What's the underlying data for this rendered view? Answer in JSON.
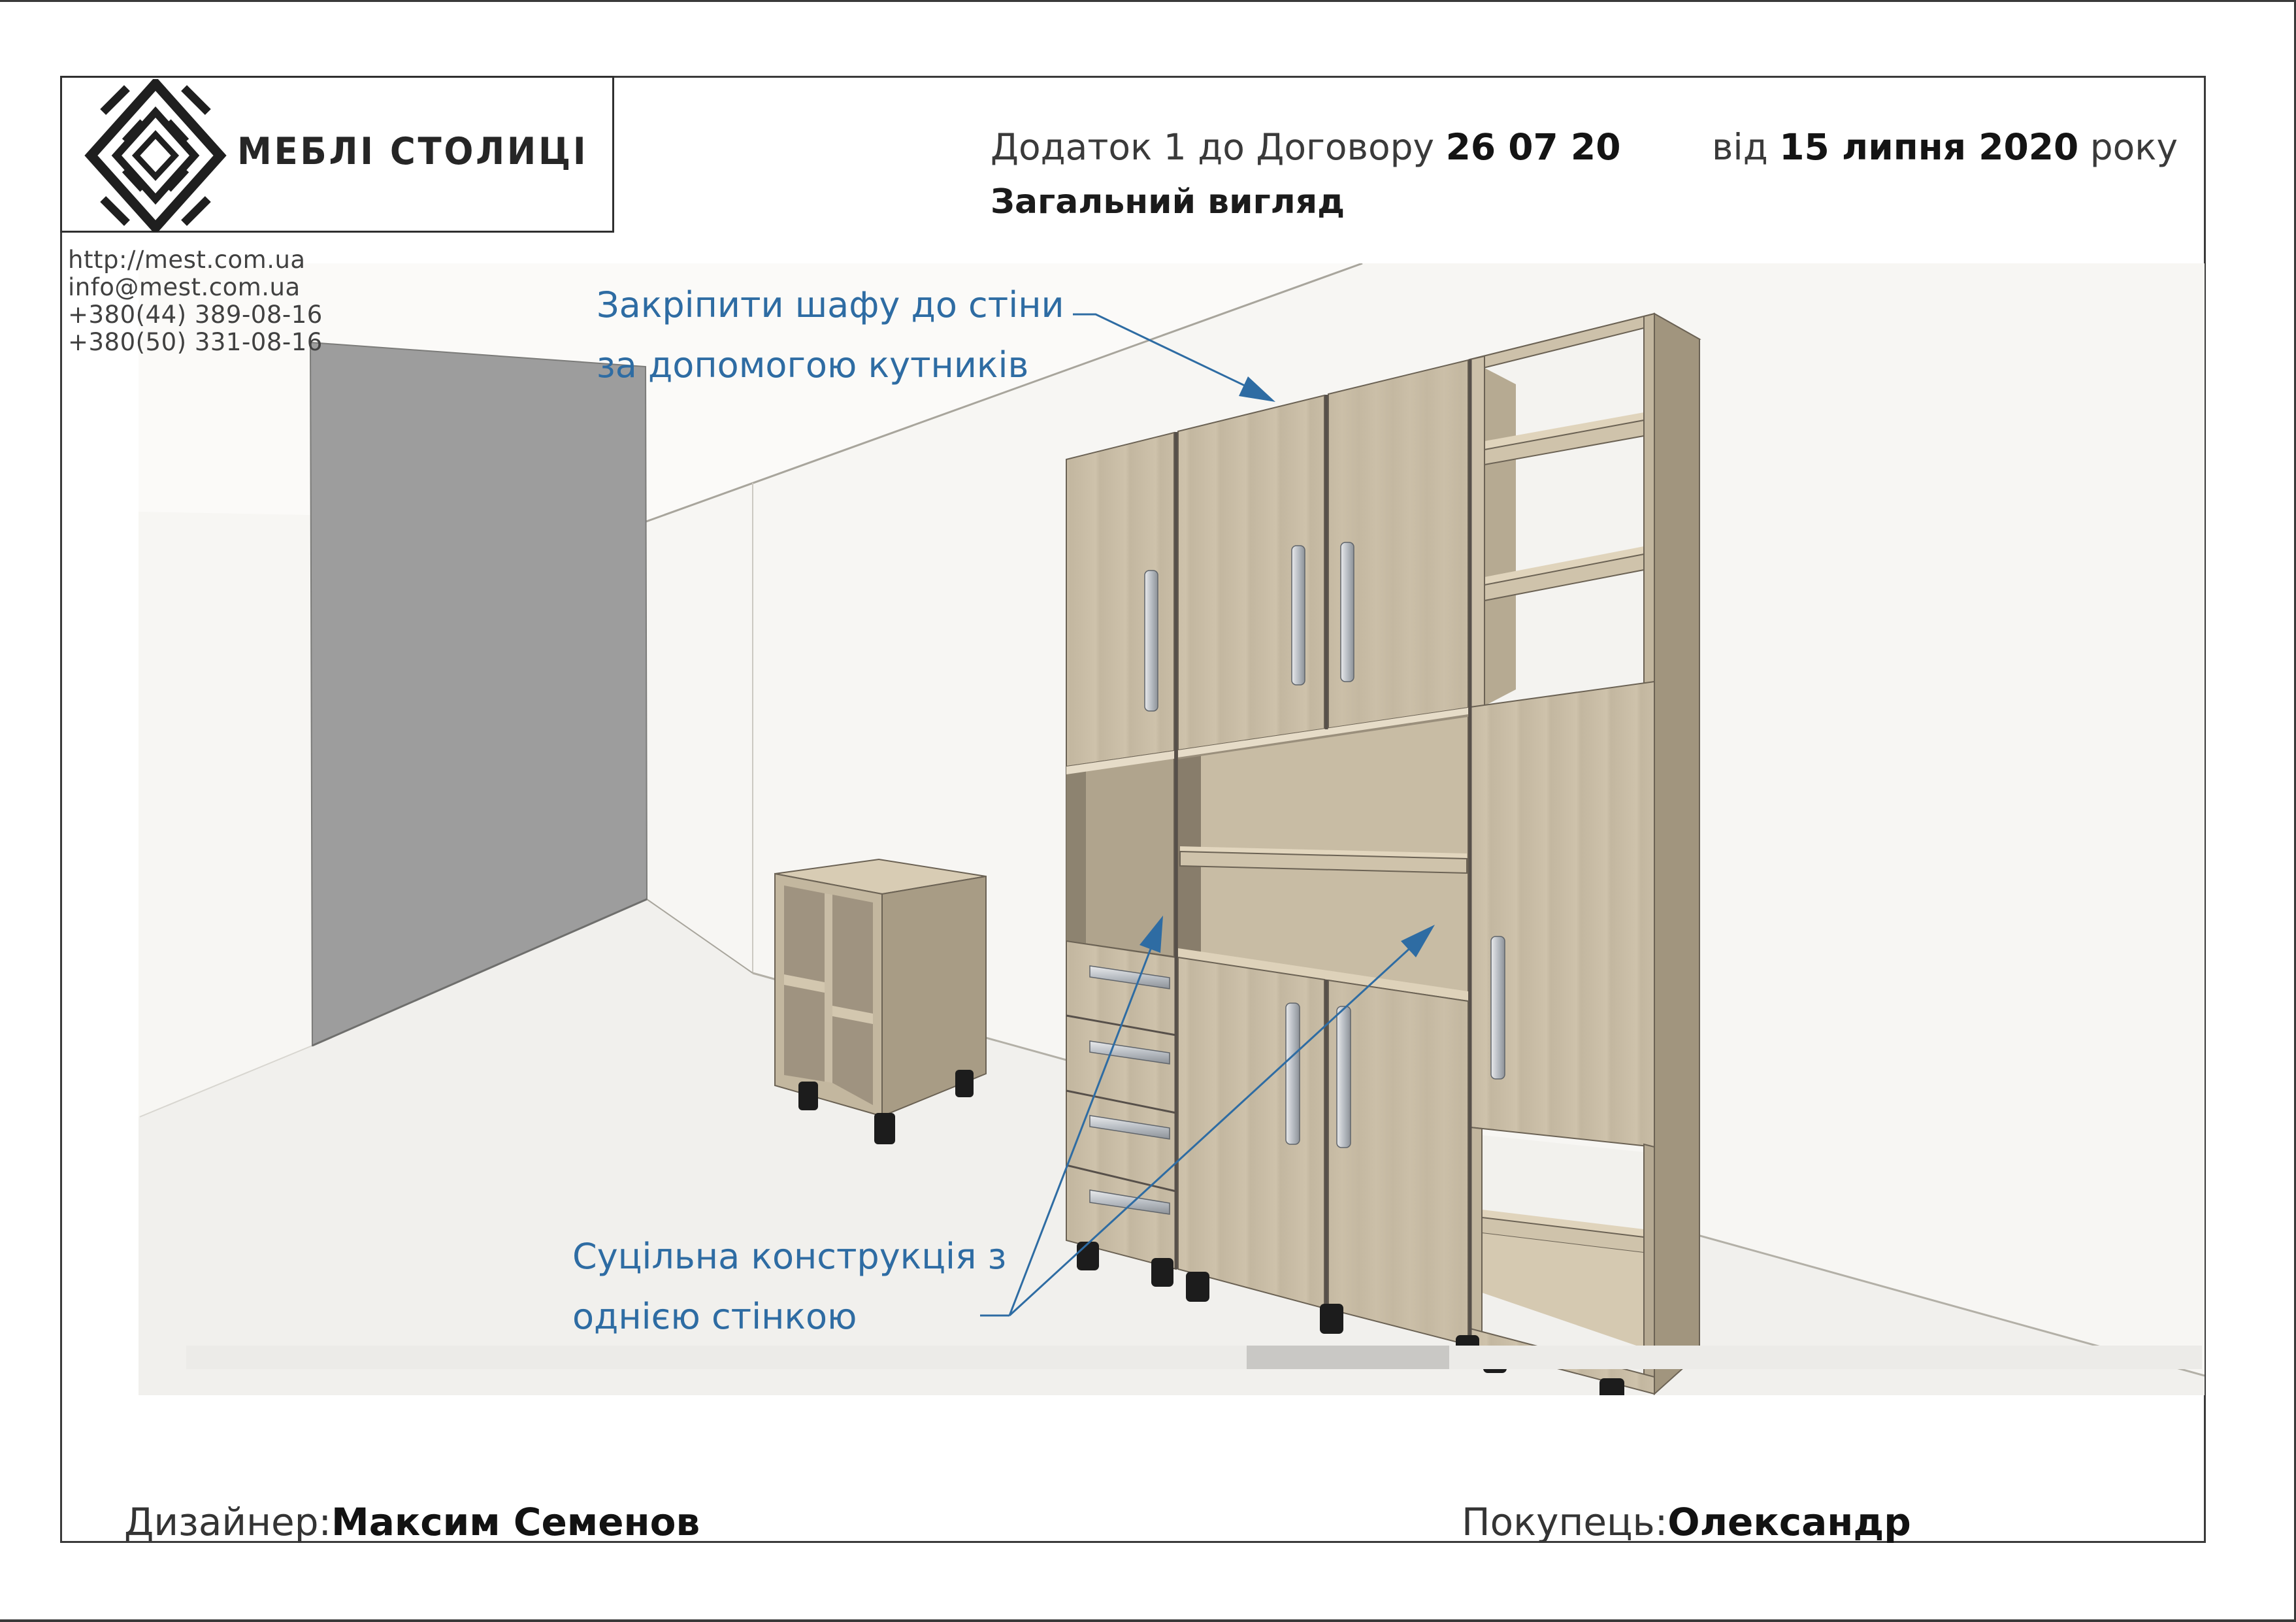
{
  "brand": {
    "name": "МЕБЛІ СТОЛИЦІ",
    "logo_icon": "nested-diamond"
  },
  "contacts": {
    "lines": [
      "http://mest.com.ua",
      "info@mest.com.ua",
      "+380(44)  389-08-16",
      "+380(50)  331-08-16"
    ]
  },
  "header": {
    "appendix_prefix": "Додаток 1 до Договору",
    "contract_number": "26 07 20",
    "date_prefix": "від",
    "date": "15 липня 2020",
    "date_suffix": "року",
    "subtitle": "Загальний вигляд"
  },
  "annotations": {
    "fix_note": {
      "line1": "Закріпити шафу до стіни",
      "line2": "за допомогою кутників"
    },
    "solid_note": {
      "line1": "Суцільна конструкція з",
      "line2": "однією стінкою"
    }
  },
  "footer": {
    "designer_label": "Дизайнер:",
    "designer_name": "Максим Семенов",
    "buyer_label": "Покупець:",
    "buyer_name": "Олександр"
  },
  "colors": {
    "accent_blue": "#2e6ca3",
    "wall_gray": "#9d9d9d",
    "wood_front": "#c8bca5",
    "wood_side": "#a89c85",
    "wood_top": "#d9cdb5",
    "frame_line": "#3a3a3a"
  }
}
